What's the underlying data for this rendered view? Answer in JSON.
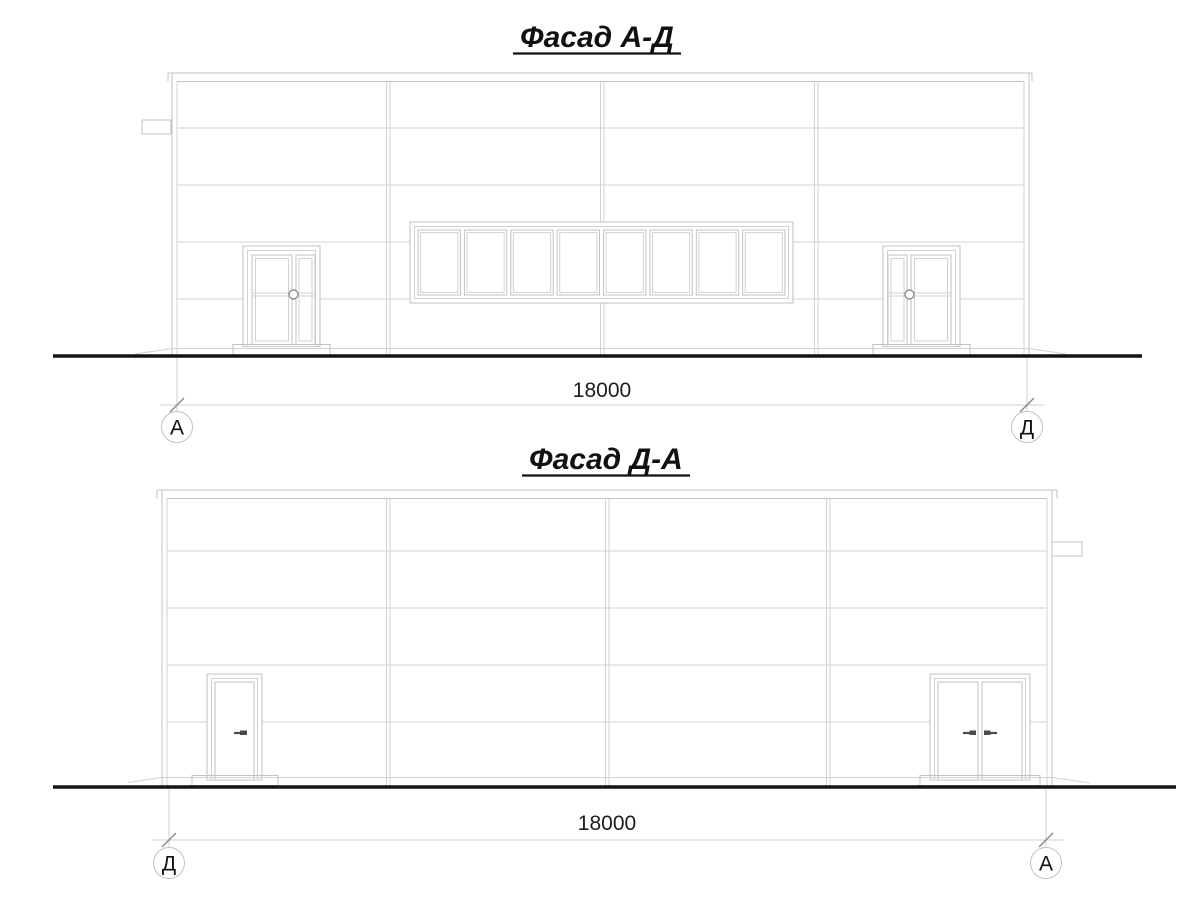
{
  "drawing": {
    "facade_top": {
      "title": "Фасад А-Д",
      "dimension_label": "18000",
      "axis_left_label": "А",
      "axis_right_label": "Д"
    },
    "facade_bottom": {
      "title": "Фасад Д-А",
      "dimension_label": "18000",
      "axis_left_label": "Д",
      "axis_right_label": "А"
    }
  },
  "colors": {
    "background": "#ffffff",
    "drawing_line": "#c2c2c2",
    "ground_line": "#141414",
    "text": "#111111",
    "tick_mark": "#8a8a8a"
  }
}
